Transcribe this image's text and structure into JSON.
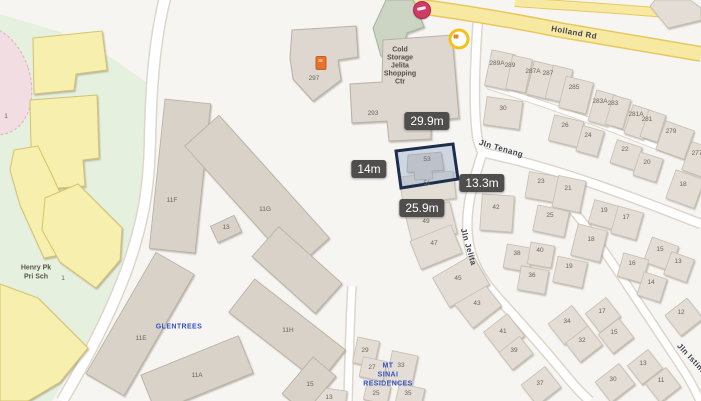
{
  "map": {
    "road_labels": [
      {
        "t": "Holland Rd",
        "x": 574,
        "y": 33,
        "r": 10
      },
      {
        "t": "Jln Tenang",
        "x": 501,
        "y": 149,
        "r": 16
      },
      {
        "t": "Jln Jelita",
        "x": 468,
        "y": 247,
        "r": 74
      },
      {
        "t": "Jln Istimewa",
        "x": 696,
        "y": 364,
        "r": 47
      }
    ],
    "measurements": [
      {
        "t": "29.9m",
        "x": 427,
        "y": 121
      },
      {
        "t": "14m",
        "x": 369,
        "y": 169
      },
      {
        "t": "13.3m",
        "x": 482,
        "y": 183
      },
      {
        "t": "25.9m",
        "x": 422,
        "y": 208
      }
    ],
    "selected_lot": {
      "building_no": "53"
    },
    "shopping_centre": {
      "lines": [
        "Cold",
        "Storage",
        "Jelita",
        "Shopping",
        "Ctr"
      ],
      "x": 400,
      "y": 50,
      "lh": 8
    },
    "condos": [
      {
        "lines": [
          "GLENTREES"
        ],
        "x": 179,
        "y": 327,
        "lh": 9
      },
      {
        "lines": [
          "MT",
          "SINAI",
          "RESIDENCES"
        ],
        "x": 388,
        "y": 366,
        "lh": 9
      }
    ],
    "school": {
      "lines": [
        "Henry Pk",
        "Pri Sch"
      ],
      "x": 36,
      "y": 268,
      "lh": 9
    },
    "house_labels": [
      {
        "t": "289A",
        "x": 497,
        "y": 64
      },
      {
        "t": "289",
        "x": 510,
        "y": 66
      },
      {
        "t": "287A",
        "x": 533,
        "y": 72
      },
      {
        "t": "287",
        "x": 548,
        "y": 74
      },
      {
        "t": "285",
        "x": 574,
        "y": 88
      },
      {
        "t": "283A",
        "x": 600,
        "y": 102
      },
      {
        "t": "283",
        "x": 613,
        "y": 104
      },
      {
        "t": "281A",
        "x": 636,
        "y": 115
      },
      {
        "t": "281",
        "x": 647,
        "y": 120
      },
      {
        "t": "279",
        "x": 671,
        "y": 132
      },
      {
        "t": "277",
        "x": 697,
        "y": 154
      },
      {
        "t": "30",
        "x": 503,
        "y": 109
      },
      {
        "t": "26",
        "x": 565,
        "y": 126
      },
      {
        "t": "24",
        "x": 588,
        "y": 136
      },
      {
        "t": "22",
        "x": 625,
        "y": 150
      },
      {
        "t": "20",
        "x": 647,
        "y": 163
      },
      {
        "t": "18",
        "x": 683,
        "y": 185
      },
      {
        "t": "23",
        "x": 541,
        "y": 182
      },
      {
        "t": "21",
        "x": 568,
        "y": 189
      },
      {
        "t": "19",
        "x": 604,
        "y": 211
      },
      {
        "t": "17",
        "x": 626,
        "y": 218
      },
      {
        "t": "15",
        "x": 660,
        "y": 250
      },
      {
        "t": "13",
        "x": 678,
        "y": 262
      },
      {
        "t": "42",
        "x": 496,
        "y": 208
      },
      {
        "t": "25",
        "x": 550,
        "y": 216
      },
      {
        "t": "18",
        "x": 591,
        "y": 240
      },
      {
        "t": "19",
        "x": 569,
        "y": 267
      },
      {
        "t": "16",
        "x": 632,
        "y": 264
      },
      {
        "t": "14",
        "x": 651,
        "y": 283
      },
      {
        "t": "38",
        "x": 517,
        "y": 254
      },
      {
        "t": "40",
        "x": 540,
        "y": 251
      },
      {
        "t": "36",
        "x": 532,
        "y": 276
      },
      {
        "t": "12",
        "x": 681,
        "y": 313
      },
      {
        "t": "17",
        "x": 602,
        "y": 312
      },
      {
        "t": "15",
        "x": 614,
        "y": 333
      },
      {
        "t": "13",
        "x": 643,
        "y": 364
      },
      {
        "t": "11",
        "x": 661,
        "y": 381
      },
      {
        "t": "34",
        "x": 567,
        "y": 322
      },
      {
        "t": "32",
        "x": 582,
        "y": 341
      },
      {
        "t": "30",
        "x": 613,
        "y": 380
      },
      {
        "t": "43",
        "x": 477,
        "y": 304
      },
      {
        "t": "41",
        "x": 503,
        "y": 332
      },
      {
        "t": "39",
        "x": 514,
        "y": 351
      },
      {
        "t": "37",
        "x": 540,
        "y": 384
      },
      {
        "t": "45",
        "x": 458,
        "y": 279
      },
      {
        "t": "47",
        "x": 434,
        "y": 244
      },
      {
        "t": "49",
        "x": 426,
        "y": 222
      },
      {
        "t": "51",
        "x": 427,
        "y": 184
      },
      {
        "t": "53",
        "x": 427,
        "y": 160
      },
      {
        "t": "297",
        "x": 314,
        "y": 79
      },
      {
        "t": "293",
        "x": 373,
        "y": 114
      },
      {
        "t": "11F",
        "x": 172,
        "y": 201
      },
      {
        "t": "11G",
        "x": 265,
        "y": 210
      },
      {
        "t": "13",
        "x": 226,
        "y": 228
      },
      {
        "t": "11E",
        "x": 141,
        "y": 339
      },
      {
        "t": "11A",
        "x": 197,
        "y": 376
      },
      {
        "t": "11H",
        "x": 288,
        "y": 331
      },
      {
        "t": "15",
        "x": 310,
        "y": 385
      },
      {
        "t": "29",
        "x": 365,
        "y": 351
      },
      {
        "t": "27",
        "x": 372,
        "y": 368
      },
      {
        "t": "33",
        "x": 401,
        "y": 366
      },
      {
        "t": "25",
        "x": 376,
        "y": 394
      },
      {
        "t": "35",
        "x": 408,
        "y": 394
      },
      {
        "t": "13",
        "x": 329,
        "y": 398
      },
      {
        "t": "1",
        "x": 63,
        "y": 279
      },
      {
        "t": "1",
        "x": 6,
        "y": 117
      }
    ],
    "poi_icons": [
      {
        "name": "red-poi-icon",
        "x": 422,
        "y": 10,
        "type": "red"
      },
      {
        "name": "yellow-poi-icon",
        "x": 459,
        "y": 39,
        "type": "yellow"
      },
      {
        "name": "shop-poi-icon",
        "x": 321,
        "y": 63,
        "type": "orange"
      }
    ],
    "colors": {
      "road_yellow": "#f8e9a2",
      "selection_outline": "#1d2d4d",
      "selection_fill": "rgba(150,172,203,0.42)",
      "measurement_bg": "#4f4e4c",
      "condo_label_blue": "#3350c4",
      "school_yellow": "#f6efae",
      "field_green": "#e6f0de",
      "poi_red": "#cf3a66",
      "poi_yellow": "#f3c117",
      "poi_orange": "#e5732e"
    }
  }
}
